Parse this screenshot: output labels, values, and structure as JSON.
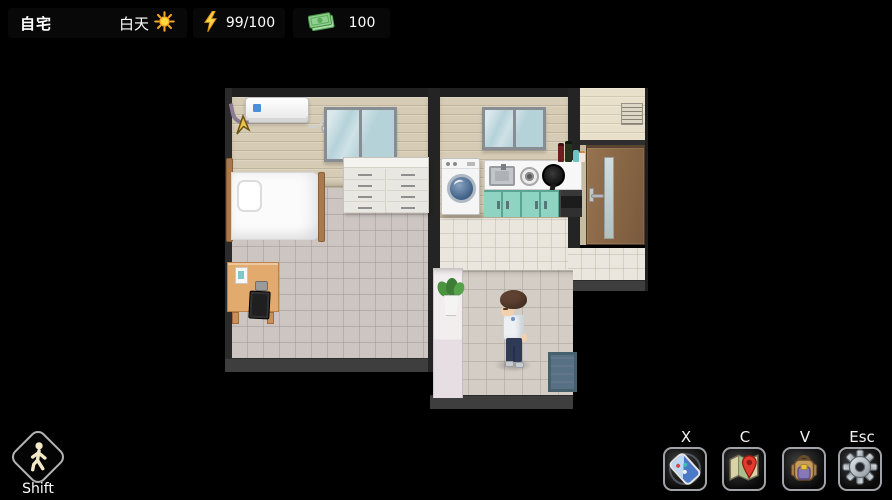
{
  "hud": {
    "location": "自宅",
    "time": "白天",
    "energy": "99/100",
    "money": "100",
    "move_key": {
      "label": "Shift",
      "icon": "walking-person-icon"
    },
    "hotkeys": [
      {
        "key": "X",
        "icon": "phone-icon"
      },
      {
        "key": "C",
        "icon": "map-icon"
      },
      {
        "key": "V",
        "icon": "backpack-icon"
      },
      {
        "key": "Esc",
        "icon": "settings-gear-icon"
      }
    ],
    "status_icons": {
      "time": "sun-icon",
      "energy": "lightning-icon",
      "money": "banknote-icon"
    }
  },
  "scene": {
    "name": "home-interior",
    "rooms": [
      "bedroom",
      "kitchen",
      "entry-hall"
    ],
    "objects": [
      "air-conditioner",
      "bedroom-window",
      "kitchen-window",
      "bed",
      "pillow",
      "dresser",
      "desk",
      "laptop",
      "document",
      "washing-machine",
      "kitchen-counter",
      "sink",
      "stove-burner",
      "wok",
      "teal-cabinets",
      "oven",
      "condiment-bottles",
      "wall-vent",
      "entry-door",
      "potted-plant",
      "doormat",
      "player-character",
      "cursor-arrow"
    ]
  },
  "colors": {
    "background": "#000000",
    "hud_bar_bg": "rgba(10,10,10,0.84)",
    "wall_wood": "#d6ccb5",
    "wall_entry": "#e8e0ca",
    "floor_bedroom": "#ccc5c2",
    "floor_kitchen": "#eae6dd",
    "floor_corridor": "#d3cdc5",
    "cabinet_teal": "#8fd3c3",
    "door_brown": "#8a6747",
    "doormat_blue": "#587083",
    "energy_yellow": "#ffd24a",
    "money_green": "#8fd08f"
  }
}
